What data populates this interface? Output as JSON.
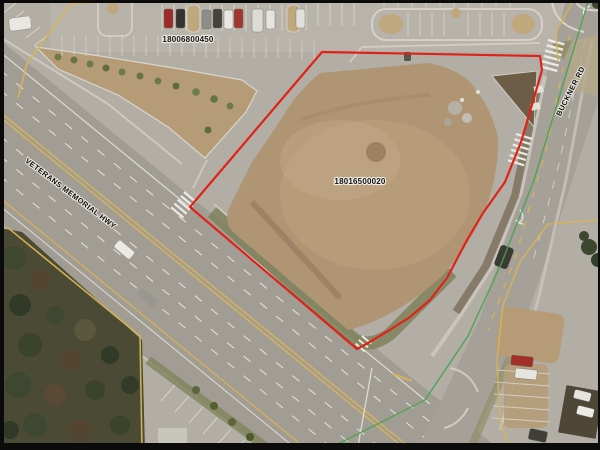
{
  "map": {
    "type": "aerial-parcel-map",
    "parcel_labels": [
      {
        "id": "18006800450"
      },
      {
        "id": "18016500020"
      }
    ],
    "road_labels": [
      {
        "name": "VETERANS MEMORIAL HWY"
      },
      {
        "name": "BUCKNER RD"
      }
    ],
    "colors": {
      "parcel_boundary_red": "#e02218",
      "parcel_line_yellow": "#d9b452",
      "utility_line_green": "#46a34e",
      "asphalt": "#a19d94",
      "dirt_pad": "#b09574",
      "forest": "#4a4a35",
      "frame_border": "#0b0b0b"
    }
  }
}
